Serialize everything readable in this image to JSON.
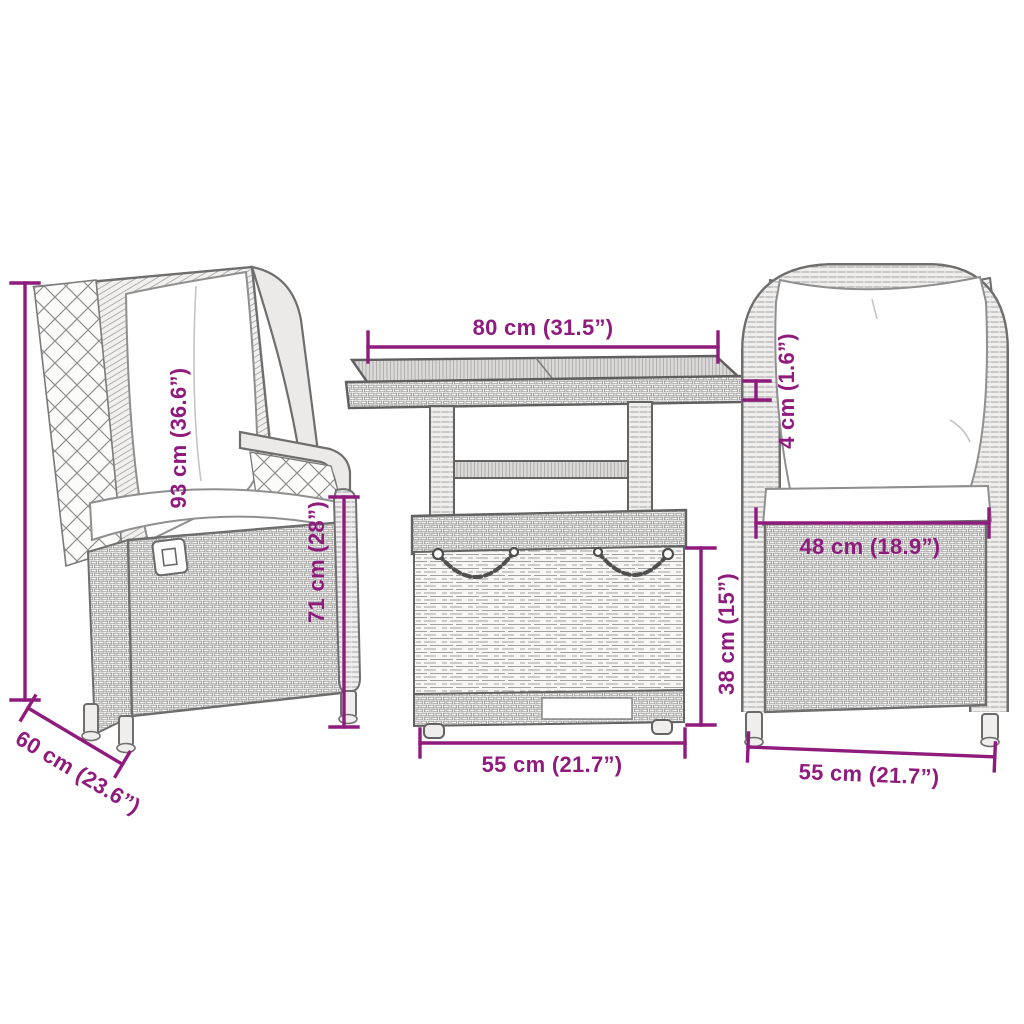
{
  "page": {
    "type": "product-dimension-diagram",
    "background_color": "#ffffff",
    "dimension_color": "#8f1b7d",
    "furniture_line_color": "#6e6e6e",
    "cushion_color": "#ffffff"
  },
  "furniture": {
    "left_chair": "reclining rattan chair with cushions (three-quarter view)",
    "table": "height-adjustable rattan table with lift top and chains (front view)",
    "right_chair": "rattan chair with cushions (front view)"
  },
  "dimensions": {
    "table_top_width": "80 cm (31.5”)",
    "chair_total_height": "93 cm (36.6”)",
    "chair_armrest_height": "71 cm (28”)",
    "table_top_thickness": "4 cm (1.6”)",
    "chair_seat_width": "48 cm (18.9”)",
    "table_base_height": "38 cm (15”)",
    "table_base_width": "55 cm (21.7”)",
    "chair_width": "55 cm (21.7”)",
    "chair_depth": "60 cm (23.6”)"
  }
}
